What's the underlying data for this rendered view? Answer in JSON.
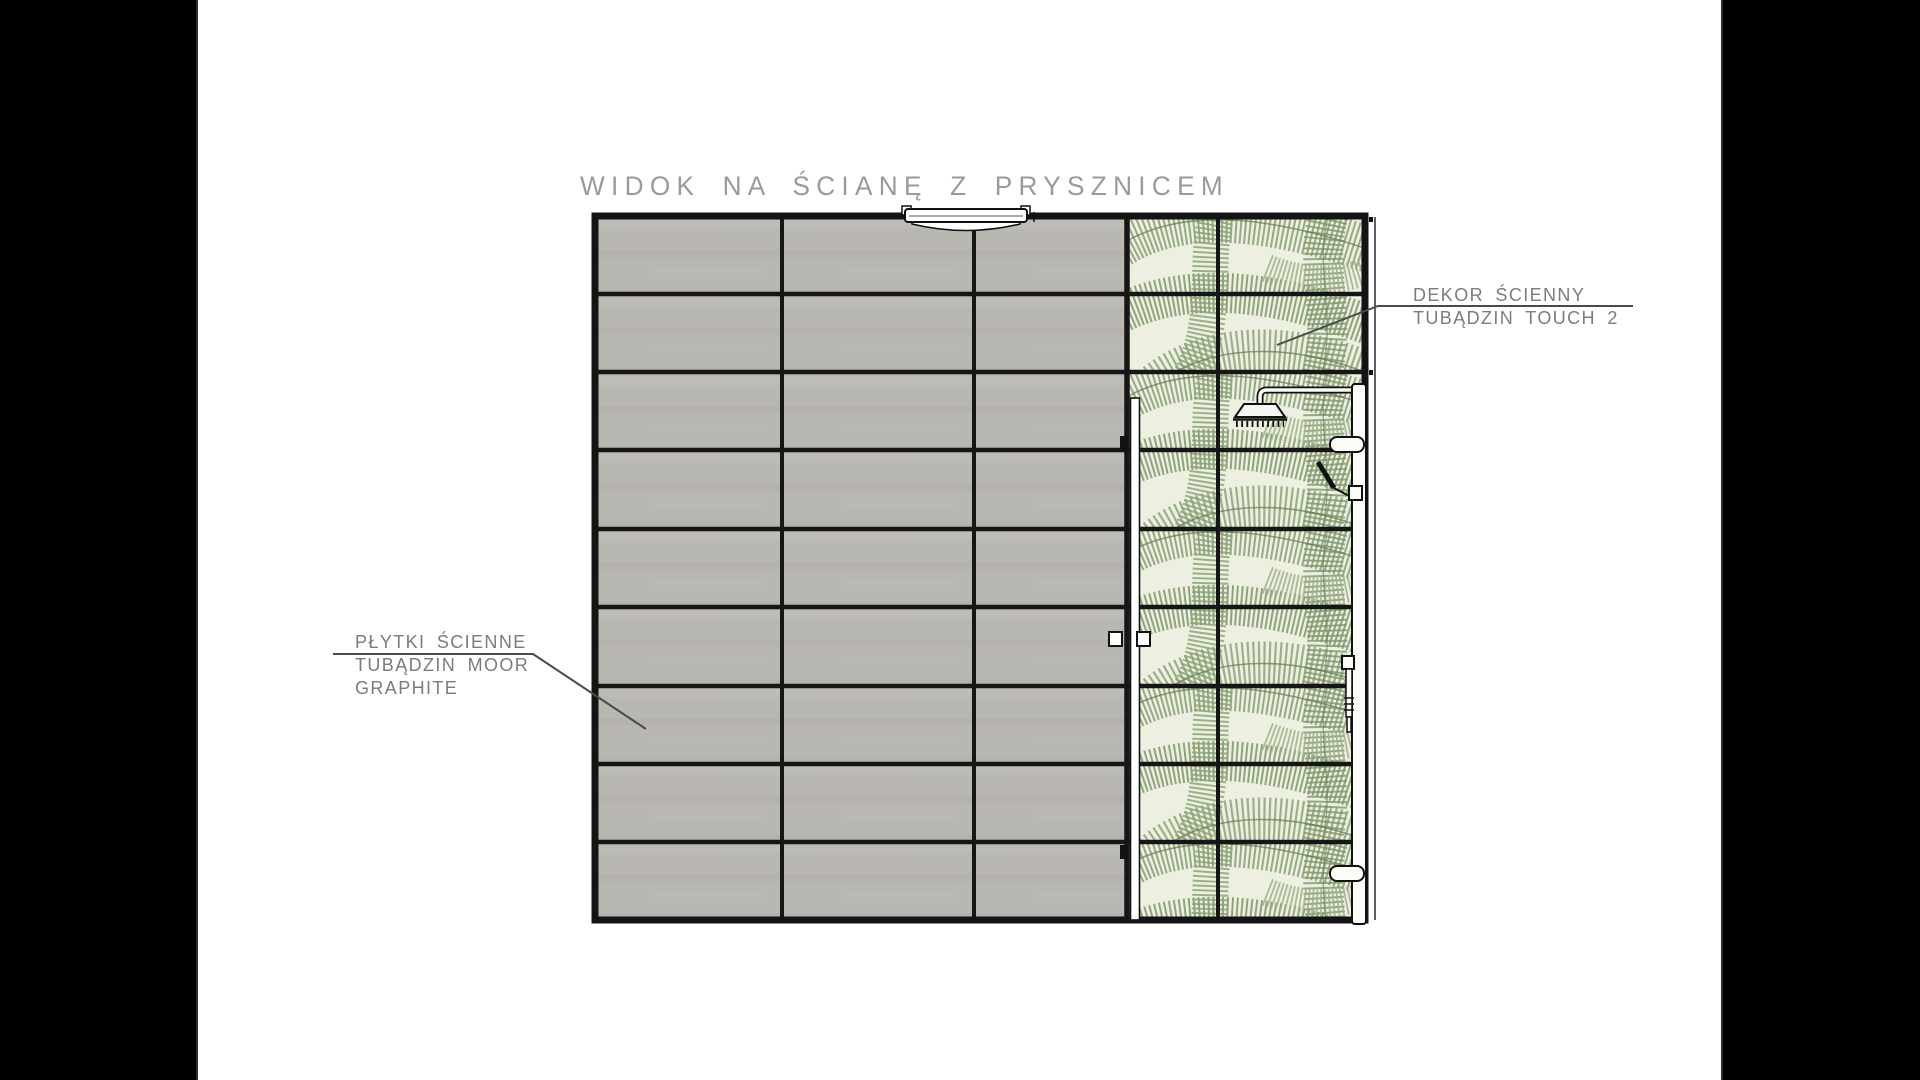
{
  "scene": {
    "type": "architectural elevation drawing",
    "subject": "bathroom shower wall"
  },
  "title": {
    "text": "WIDOK NA ŚCIANĘ Z PRYSZNICEM"
  },
  "annotations": {
    "wall_tiles": {
      "line1": "PŁYTKI ŚCIENNE",
      "line2": "TUBĄDZIN MOOR",
      "line3": "GRAPHITE"
    },
    "decor_tiles": {
      "line1": "DEKOR ŚCIENNY",
      "line2": "TUBĄDZIN TOUCH 2"
    }
  },
  "wall": {
    "tile_rows": 9,
    "gray_tile_columns": 3,
    "decor_tile_columns": 2,
    "fixtures": [
      "ceiling-lamp",
      "rain-shower-head",
      "shower-pipe",
      "shower-column",
      "hand-shower",
      "glass-door",
      "door-handle",
      "door-hinges"
    ]
  },
  "colors": {
    "pillarbox": "#000000",
    "canvas": "#ffffff",
    "tile_gray": "#b9b7b2",
    "grout": "#161616",
    "decor_base": "#edefe0",
    "decor_leaf": "#8ca37a",
    "decor_leaf_dark": "#7e966b",
    "annotation_text": "#7c7c7c",
    "title_text": "#9a9a9a",
    "leader_line": "#4a4a4a"
  }
}
